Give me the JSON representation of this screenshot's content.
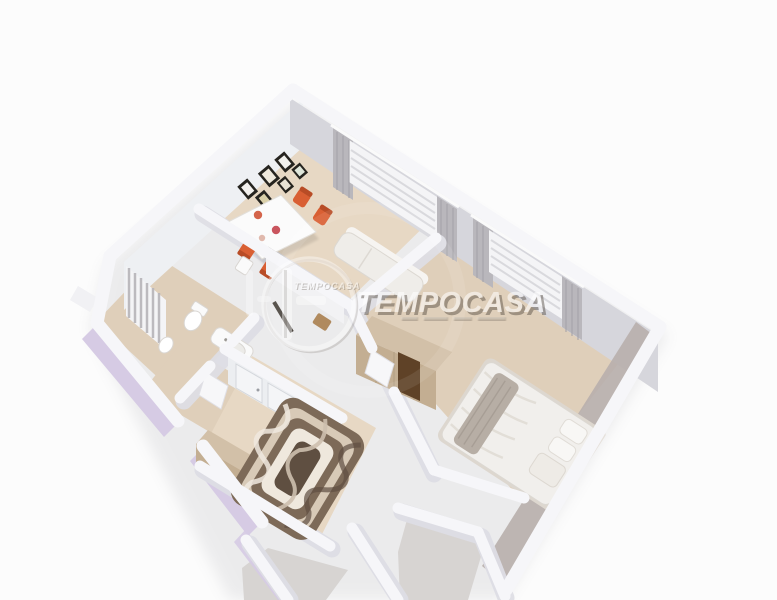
{
  "scene": {
    "description": "3D rendered dollhouse-view floor plan of an apartment, viewed from above at an angle on a white background",
    "rooms": [
      {
        "name": "living-dining-room",
        "contents": [
          "dining-table",
          "four-orange-chairs",
          "gallery-picture-frames",
          "window-with-blinds-and-curtains",
          "white-sofa",
          "kitchen-counter"
        ]
      },
      {
        "name": "bathroom",
        "contents": [
          "shower-curtain",
          "toilet",
          "bidet",
          "white-vanity-unit",
          "window-with-curtain"
        ]
      },
      {
        "name": "bedroom",
        "contents": [
          "double-bed-white-linen",
          "gray-throw",
          "pillows",
          "tan-wardrobe-with-dark-panel",
          "window-with-blinds-and-curtains"
        ]
      },
      {
        "name": "hallway-room",
        "contents": [
          "swirl-pattern-rug",
          "built-in-white-wardrobe",
          "tan-sideboard"
        ]
      },
      {
        "name": "small-room-bottom-left",
        "contents": []
      },
      {
        "name": "small-room-bottom-right",
        "contents": []
      }
    ]
  },
  "watermark": {
    "brand_large": "TEMPOCASA",
    "brand_small": "TEMPOCASA"
  },
  "palette": {
    "background": "#fcfcfc",
    "wall_top": "#f6f6f9",
    "wall_face": "#eef0f3",
    "wall_face_dark": "#d6d6dc",
    "wall_taupe": "#b8b0ac",
    "wall_lilac": "#d6cbe4",
    "floor_beige": "#e7d8c4",
    "floor_beige_dark": "#dfcfba",
    "floor_gray": "#d7d4d2",
    "chair_orange": "#d95f33",
    "chair_orange_dark": "#b84c26",
    "table_white": "#fbfbfb",
    "sofa_white": "#efede9",
    "curtain_gray": "#b9b7bc",
    "blind_white": "#f4f4f6",
    "counter_dark": "#47423e",
    "wood_tan": "#d2c0a8",
    "wood_tan_front": "#c3ae92",
    "panel_brown": "#5f4227",
    "bed_linen": "#f1efec",
    "bed_throw": "#b7aea5",
    "rug_dark": "#5f4f41",
    "rug_mid": "#7d6a58",
    "rug_light": "#d8cab7",
    "rug_cream": "#efe8dd",
    "frame_dark": "#26241f",
    "watermark_white": "#ffffff",
    "watermark_shadow": "#4f463c"
  }
}
